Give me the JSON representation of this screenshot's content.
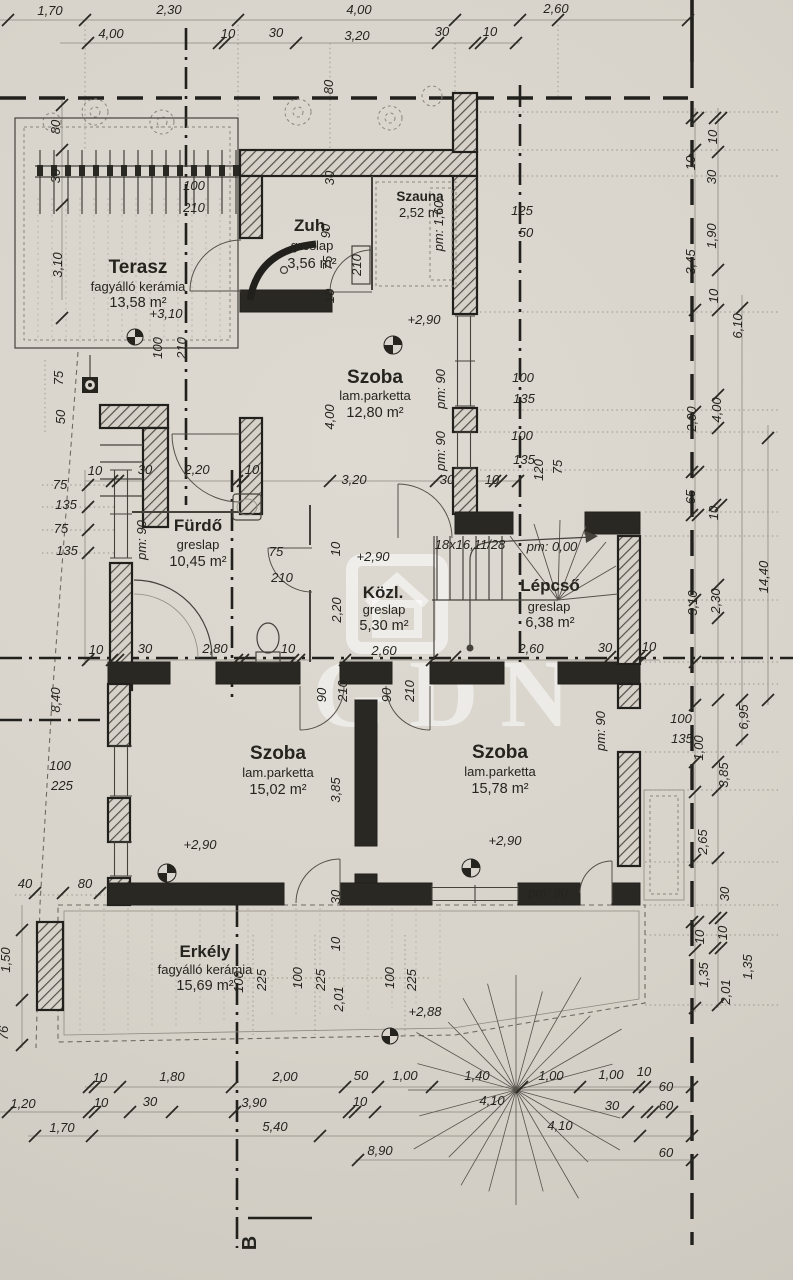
{
  "drawing": {
    "section_marker": "B"
  },
  "watermark": {
    "text": "GDN"
  },
  "colors": {
    "paper": "#d9d5cc",
    "ink": "#26241f",
    "line_light": "#9a958b",
    "watermark": "rgba(255,255,255,0.5)"
  },
  "rooms": {
    "terasz": {
      "name": "Terasz",
      "finish": "fagyálló kerámia",
      "area": "13,58 m²"
    },
    "zuh": {
      "name": "Zuh.",
      "finish": "greslap",
      "area": "3,56 m²"
    },
    "szauna": {
      "name": "Szauna",
      "area": "2,52 m²"
    },
    "szoba1": {
      "name": "Szoba",
      "finish": "lam.parketta",
      "area": "12,80 m²"
    },
    "furdo": {
      "name": "Fürdő",
      "finish": "greslap",
      "area": "10,45 m²"
    },
    "kozl": {
      "name": "Közl.",
      "finish": "greslap",
      "area": "5,30 m²"
    },
    "lepcso": {
      "name": "Lépcső",
      "finish": "greslap",
      "area": "6,38 m²"
    },
    "szoba2": {
      "name": "Szoba",
      "finish": "lam.parketta",
      "area": "15,02 m²"
    },
    "szoba3": {
      "name": "Szoba",
      "finish": "lam.parketta",
      "area": "15,78 m²"
    },
    "erkely": {
      "name": "Erkély",
      "finish": "fagyálló kerámia",
      "area": "15,69 m²"
    }
  },
  "dims": [
    {
      "t": "1,70"
    },
    {
      "t": "2,30"
    },
    {
      "t": "4,00"
    },
    {
      "t": "2,60"
    },
    {
      "t": "4,00"
    },
    {
      "t": "10"
    },
    {
      "t": "30"
    },
    {
      "t": "3,20"
    },
    {
      "t": "30"
    },
    {
      "t": "10"
    },
    {
      "t": "80"
    },
    {
      "t": "80"
    },
    {
      "t": "30"
    },
    {
      "t": "3,10"
    },
    {
      "t": "100"
    },
    {
      "t": "210"
    },
    {
      "t": "100"
    },
    {
      "t": "210"
    },
    {
      "t": "+3,10"
    },
    {
      "t": "30"
    },
    {
      "t": "90"
    },
    {
      "t": "75"
    },
    {
      "t": "210"
    },
    {
      "t": "10"
    },
    {
      "t": "pm: 1,60"
    },
    {
      "t": "125"
    },
    {
      "t": "50"
    },
    {
      "t": "+2,90"
    },
    {
      "t": "4,00"
    },
    {
      "t": "pm: 90"
    },
    {
      "t": "pm: 90"
    },
    {
      "t": "3,20"
    },
    {
      "t": "30"
    },
    {
      "t": "10"
    },
    {
      "t": "100"
    },
    {
      "t": "135"
    },
    {
      "t": "100"
    },
    {
      "t": "135"
    },
    {
      "t": "120"
    },
    {
      "t": "75"
    },
    {
      "t": "75"
    },
    {
      "t": "135"
    },
    {
      "t": "75"
    },
    {
      "t": "135"
    },
    {
      "t": "75"
    },
    {
      "t": "50"
    },
    {
      "t": "10"
    },
    {
      "t": "30"
    },
    {
      "t": "2,20"
    },
    {
      "t": "10"
    },
    {
      "t": "pm: 90"
    },
    {
      "t": "75"
    },
    {
      "t": "210"
    },
    {
      "t": "10"
    },
    {
      "t": "30"
    },
    {
      "t": "2,80"
    },
    {
      "t": "10"
    },
    {
      "t": "8,40"
    },
    {
      "t": "+2,90"
    },
    {
      "t": "10"
    },
    {
      "t": "2,20"
    },
    {
      "t": "18x16,11/28"
    },
    {
      "t": "pm: 0,00"
    },
    {
      "t": "2,60"
    },
    {
      "t": "2,60"
    },
    {
      "t": "30"
    },
    {
      "t": "10"
    },
    {
      "t": "90"
    },
    {
      "t": "210"
    },
    {
      "t": "90"
    },
    {
      "t": "210"
    },
    {
      "t": "+2,90"
    },
    {
      "t": "3,85"
    },
    {
      "t": "30"
    },
    {
      "t": "100"
    },
    {
      "t": "225"
    },
    {
      "t": "40"
    },
    {
      "t": "80"
    },
    {
      "t": "1,50"
    },
    {
      "t": "76"
    },
    {
      "t": "+2,90"
    },
    {
      "t": "pm: 90"
    },
    {
      "t": "pm: 90"
    },
    {
      "t": "100"
    },
    {
      "t": "225"
    },
    {
      "t": "100"
    },
    {
      "t": "225"
    },
    {
      "t": "10"
    },
    {
      "t": "2,01"
    },
    {
      "t": "100"
    },
    {
      "t": "225"
    },
    {
      "t": "+2,88"
    },
    {
      "t": "10"
    },
    {
      "t": "10"
    },
    {
      "t": "30"
    },
    {
      "t": "1,90"
    },
    {
      "t": "3,45"
    },
    {
      "t": "10"
    },
    {
      "t": "6,10"
    },
    {
      "t": "2,00"
    },
    {
      "t": "4,00"
    },
    {
      "t": "65"
    },
    {
      "t": "10"
    },
    {
      "t": "3,10"
    },
    {
      "t": "2,30"
    },
    {
      "t": "14,40"
    },
    {
      "t": "100"
    },
    {
      "t": "135"
    },
    {
      "t": "1,00"
    },
    {
      "t": "6,95"
    },
    {
      "t": "3,85"
    },
    {
      "t": "2,65"
    },
    {
      "t": "30"
    },
    {
      "t": "10"
    },
    {
      "t": "10"
    },
    {
      "t": "1,35"
    },
    {
      "t": "1,35"
    },
    {
      "t": "2,01"
    },
    {
      "t": "10"
    },
    {
      "t": "60"
    },
    {
      "t": "30"
    },
    {
      "t": "60"
    },
    {
      "t": "60"
    },
    {
      "t": "10"
    },
    {
      "t": "1,80"
    },
    {
      "t": "2,00"
    },
    {
      "t": "50"
    },
    {
      "t": "1,00"
    },
    {
      "t": "1,40"
    },
    {
      "t": "1,00"
    },
    {
      "t": "1,00"
    },
    {
      "t": "1,20"
    },
    {
      "t": "10"
    },
    {
      "t": "30"
    },
    {
      "t": "3,90"
    },
    {
      "t": "10"
    },
    {
      "t": "4,10"
    },
    {
      "t": "1,70"
    },
    {
      "t": "5,40"
    },
    {
      "t": "4,10"
    },
    {
      "t": "8,90"
    }
  ]
}
